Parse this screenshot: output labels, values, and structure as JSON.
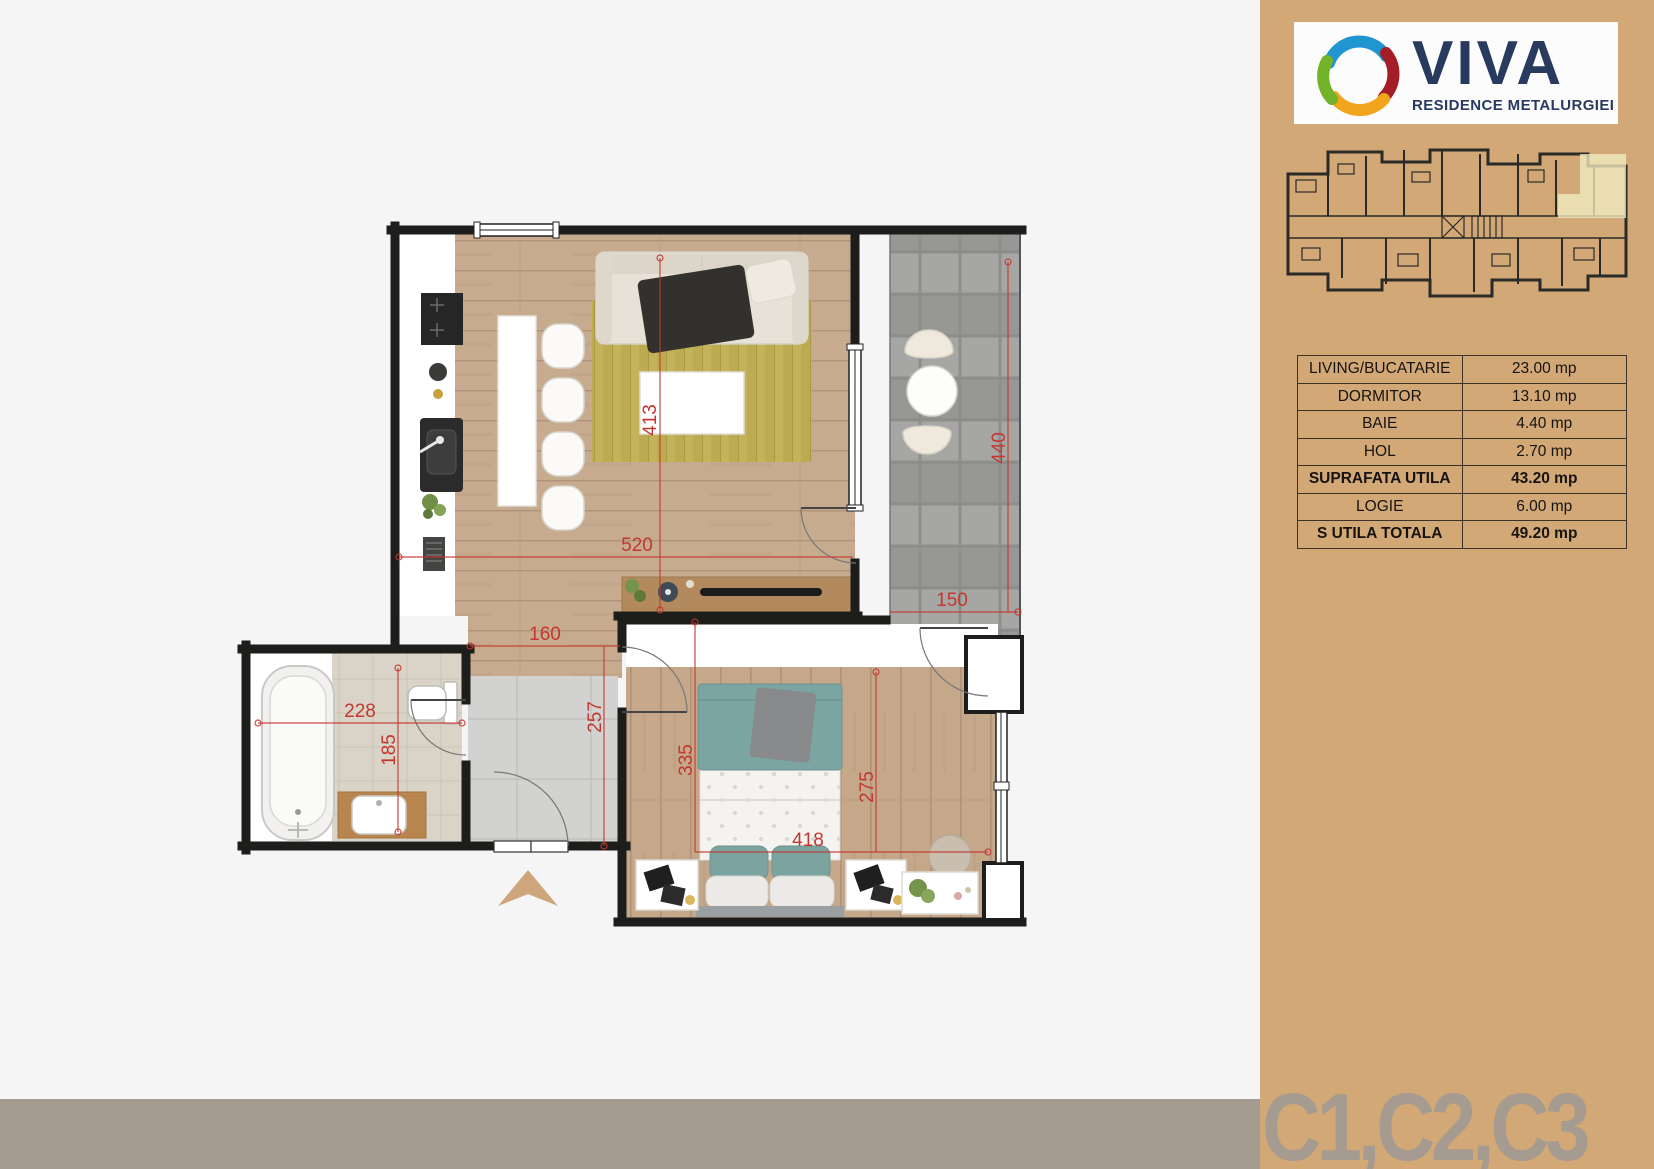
{
  "sidebar": {
    "logo": {
      "brand": "VIVA",
      "tagline": "RESIDENCE METALURGIEI"
    },
    "area_table": {
      "rows": [
        {
          "label": "LIVING/BUCATARIE",
          "value": "23.00 mp",
          "bold": false
        },
        {
          "label": "DORMITOR",
          "value": "13.10 mp",
          "bold": false
        },
        {
          "label": "BAIE",
          "value": "4.40 mp",
          "bold": false
        },
        {
          "label": "HOL",
          "value": "2.70 mp",
          "bold": false
        },
        {
          "label": "SUPRAFATA UTILA",
          "value": "43.20 mp",
          "bold": true
        },
        {
          "label": "LOGIE",
          "value": "6.00 mp",
          "bold": false
        },
        {
          "label": "S UTILA TOTALA",
          "value": "49.20 mp",
          "bold": true
        }
      ]
    },
    "unit_label": "C1,C2,C3"
  },
  "floor_plan": {
    "dimensions_cm": {
      "living_height": "413",
      "living_width": "520",
      "logie_height": "440",
      "logie_width": "150",
      "hall_width": "160",
      "hall_height": "257",
      "bath_width": "228",
      "bath_height": "185",
      "bedroom_height_left": "335",
      "bedroom_height_right": "275",
      "bedroom_width": "418"
    }
  },
  "colors": {
    "sidebar_bg": "#d2a876",
    "bottom_bar": "#a69b91",
    "unit_label_text": "#a69b91",
    "dimension_red": "#c4372f",
    "brand_navy": "#283a5e",
    "highlight_unit": "#f1ecc0",
    "plan_background": "#f4f5f4",
    "wall_black": "#1d1d1b",
    "wood_floor": "#c7ab8f",
    "rug_olive": "#bcab50",
    "balcony_tile": "#9e9e9c"
  }
}
